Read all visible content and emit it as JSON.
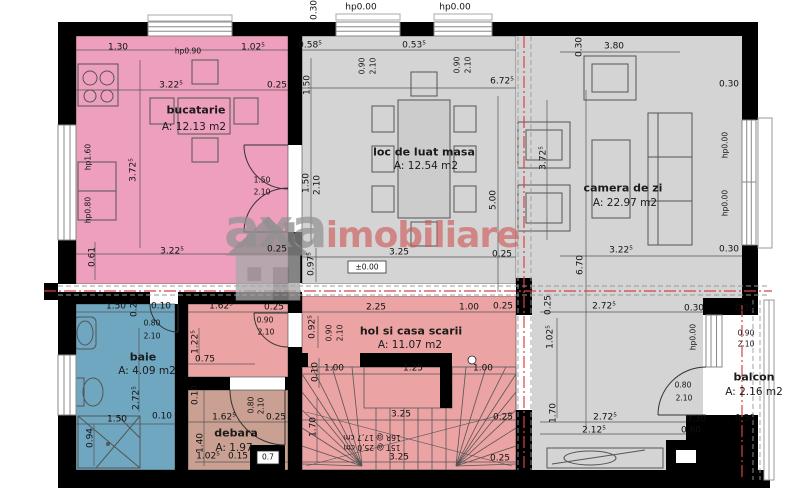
{
  "plan": {
    "type": "floor-plan",
    "language": "Romanian",
    "level_marker": "±0.00",
    "stair_notes": [
      "16R @ 17,7 cm",
      "15T @ 25,0 cm"
    ]
  },
  "watermark": {
    "part1": "axa",
    "part2": "imobiliare",
    "color1": "#919191",
    "color2": "#ce5555"
  },
  "colors": {
    "wall": "#000000",
    "section_line": "#d44444",
    "hidden_line": "#999999",
    "dining_gray": "#d4d4d4",
    "kitchen_pink": "#ed9fbd",
    "hall_salmon": "#eba3a3",
    "storage_tan": "#c9a091",
    "bath_blue": "#6fa7c1",
    "balcony_white": "#ffffff"
  },
  "rooms": [
    {
      "id": "bucatarie",
      "name": "bucatarie",
      "area": "A: 12.13 m2",
      "color": "#ed9fbd",
      "nx": 196,
      "ny": 110,
      "ax": 194,
      "ay": 127
    },
    {
      "id": "masa",
      "name": "loc de luat masa",
      "area": "A: 12.54 m2",
      "color": "#d4d4d4",
      "nx": 424,
      "ny": 152,
      "ax": 426,
      "ay": 166
    },
    {
      "id": "camera",
      "name": "camera de zi",
      "area": "A: 22.97 m2",
      "color": "#d4d4d4",
      "nx": 623,
      "ny": 188,
      "ax": 625,
      "ay": 203
    },
    {
      "id": "hol",
      "name": "hol si casa scarii",
      "area": "A: 11.07 m2",
      "color": "#eba3a3",
      "nx": 411,
      "ny": 331,
      "ax": 410,
      "ay": 345
    },
    {
      "id": "baie",
      "name": "baie",
      "area": "A: 4.09 m2",
      "color": "#6fa7c1",
      "nx": 143,
      "ny": 357,
      "ax": 147,
      "ay": 371
    },
    {
      "id": "debara",
      "name": "debara",
      "area": "A: 1.97",
      "color": "#c9a091",
      "nx": 236,
      "ny": 433,
      "ax": 234,
      "ay": 448
    },
    {
      "id": "balcon",
      "name": "balcon",
      "area": "A: 2.16 m2",
      "color": "#ffffff",
      "nx": 754,
      "ny": 377,
      "ax": 754,
      "ay": 392
    }
  ],
  "dims": [
    {
      "t": "0.30",
      "x": 315,
      "y": 10,
      "r": 1
    },
    {
      "t": "hp0.00",
      "x": 361,
      "y": 8
    },
    {
      "t": "hp0.00",
      "x": 455,
      "y": 8
    },
    {
      "t": "1.30",
      "x": 118,
      "y": 48
    },
    {
      "t": "hp0.90",
      "x": 188,
      "y": 51,
      "s": 1
    },
    {
      "t": "1.02⁵",
      "x": 253,
      "y": 48
    },
    {
      "t": "0.58⁵",
      "x": 310,
      "y": 46
    },
    {
      "t": "0.53⁵",
      "x": 414,
      "y": 46
    },
    {
      "t": "3.80",
      "x": 614,
      "y": 47
    },
    {
      "t": "0.30",
      "x": 580,
      "y": 47,
      "r": 1
    },
    {
      "t": "3.22⁵",
      "x": 171,
      "y": 86
    },
    {
      "t": "0.25",
      "x": 277,
      "y": 86
    },
    {
      "t": "6.72⁵",
      "x": 502,
      "y": 82
    },
    {
      "t": "0.90",
      "x": 362,
      "y": 66,
      "r": 1,
      "s": 1
    },
    {
      "t": "2.10",
      "x": 373,
      "y": 66,
      "r": 1,
      "s": 1
    },
    {
      "t": "0.90",
      "x": 457,
      "y": 65,
      "r": 1,
      "s": 1
    },
    {
      "t": "2.10",
      "x": 468,
      "y": 65,
      "r": 1,
      "s": 1
    },
    {
      "t": "1.50",
      "x": 308,
      "y": 85,
      "r": 1
    },
    {
      "t": "0.30",
      "x": 729,
      "y": 85
    },
    {
      "t": "3.72⁵",
      "x": 134,
      "y": 170,
      "r": 1
    },
    {
      "t": "hp1.60",
      "x": 88,
      "y": 157,
      "r": 1,
      "s": 1
    },
    {
      "t": "hp0.80",
      "x": 88,
      "y": 210,
      "r": 1,
      "s": 1
    },
    {
      "t": "1.50",
      "x": 262,
      "y": 180,
      "s": 1
    },
    {
      "t": "2.10",
      "x": 262,
      "y": 192,
      "s": 1
    },
    {
      "t": "hp0.00",
      "x": 725,
      "y": 145,
      "r": 1,
      "s": 1
    },
    {
      "t": "hp0.00",
      "x": 725,
      "y": 203,
      "r": 1,
      "s": 1
    },
    {
      "t": "3.72⁵",
      "x": 544,
      "y": 158,
      "r": 1
    },
    {
      "t": "1.50",
      "x": 307,
      "y": 183,
      "r": 1
    },
    {
      "t": "2.10",
      "x": 318,
      "y": 185,
      "r": 1
    },
    {
      "t": "5.00",
      "x": 494,
      "y": 200,
      "r": 1
    },
    {
      "t": "3.22⁵",
      "x": 172,
      "y": 252
    },
    {
      "t": "0.25",
      "x": 277,
      "y": 250
    },
    {
      "t": "0.61",
      "x": 93,
      "y": 257,
      "r": 1
    },
    {
      "t": "3.22⁵",
      "x": 621,
      "y": 251
    },
    {
      "t": "0.30",
      "x": 729,
      "y": 250
    },
    {
      "t": "6.70",
      "x": 581,
      "y": 265,
      "r": 1
    },
    {
      "t": "0.97⁵",
      "x": 312,
      "y": 264,
      "r": 1
    },
    {
      "t": "3.25",
      "x": 399,
      "y": 253
    },
    {
      "t": "±0.00",
      "x": 367,
      "y": 267,
      "s": 1
    },
    {
      "t": "0.25",
      "x": 502,
      "y": 255
    },
    {
      "t": "0.25",
      "x": 549,
      "y": 305,
      "r": 1
    },
    {
      "t": "2.72⁵",
      "x": 604,
      "y": 307
    },
    {
      "t": "0.30",
      "x": 694,
      "y": 309
    },
    {
      "t": "0.50",
      "x": 745,
      "y": 309
    },
    {
      "t": "1.02⁵",
      "x": 551,
      "y": 337,
      "r": 1
    },
    {
      "t": "hp0.00",
      "x": 693,
      "y": 337,
      "r": 1,
      "s": 1
    },
    {
      "t": "0.90",
      "x": 746,
      "y": 333,
      "s": 1
    },
    {
      "t": "2.10",
      "x": 746,
      "y": 344,
      "s": 1
    },
    {
      "t": "0.80",
      "x": 683,
      "y": 385,
      "s": 1
    },
    {
      "t": "2.10",
      "x": 684,
      "y": 398,
      "s": 1
    },
    {
      "t": "1.70",
      "x": 554,
      "y": 413,
      "r": 1
    },
    {
      "t": "2.72⁵",
      "x": 605,
      "y": 418
    },
    {
      "t": "0.30",
      "x": 696,
      "y": 420
    },
    {
      "t": "0.50",
      "x": 745,
      "y": 419
    },
    {
      "t": "2.12⁵",
      "x": 594,
      "y": 431
    },
    {
      "t": "0.60",
      "x": 691,
      "y": 431
    },
    {
      "t": "1.50",
      "x": 116,
      "y": 307
    },
    {
      "t": "0.25",
      "x": 135,
      "y": 307,
      "r": 1
    },
    {
      "t": "0.10",
      "x": 161,
      "y": 307
    },
    {
      "t": "1.62⁵",
      "x": 221,
      "y": 307
    },
    {
      "t": "0.25",
      "x": 274,
      "y": 308
    },
    {
      "t": "0.90",
      "x": 265,
      "y": 320,
      "s": 1
    },
    {
      "t": "2.10",
      "x": 266,
      "y": 332,
      "s": 1
    },
    {
      "t": "2.25",
      "x": 376,
      "y": 308
    },
    {
      "t": "1.00",
      "x": 469,
      "y": 308
    },
    {
      "t": "0.25",
      "x": 503,
      "y": 307
    },
    {
      "t": "0.80",
      "x": 152,
      "y": 323,
      "s": 1
    },
    {
      "t": "2.10",
      "x": 152,
      "y": 336,
      "s": 1
    },
    {
      "t": "0.92⁵",
      "x": 313,
      "y": 327,
      "r": 1
    },
    {
      "t": "0.90",
      "x": 329,
      "y": 333,
      "r": 1,
      "s": 1
    },
    {
      "t": "2.10",
      "x": 340,
      "y": 333,
      "r": 1,
      "s": 1
    },
    {
      "t": "1.22⁵",
      "x": 196,
      "y": 342,
      "r": 1
    },
    {
      "t": "0.75",
      "x": 205,
      "y": 360
    },
    {
      "t": "2.72⁵",
      "x": 137,
      "y": 398,
      "r": 1
    },
    {
      "t": "0.10",
      "x": 316,
      "y": 372,
      "r": 1
    },
    {
      "t": "1.00",
      "x": 334,
      "y": 369
    },
    {
      "t": "1.25",
      "x": 413,
      "y": 369
    },
    {
      "t": "1.00",
      "x": 483,
      "y": 369
    },
    {
      "t": "0.10",
      "x": 196,
      "y": 395,
      "r": 1
    },
    {
      "t": "0.80",
      "x": 251,
      "y": 405,
      "r": 1,
      "s": 1
    },
    {
      "t": "2.10",
      "x": 261,
      "y": 406,
      "r": 1,
      "s": 1
    },
    {
      "t": "1.62⁵",
      "x": 224,
      "y": 418
    },
    {
      "t": "0.25",
      "x": 276,
      "y": 418
    },
    {
      "t": "1.50",
      "x": 117,
      "y": 420
    },
    {
      "t": "0.10",
      "x": 162,
      "y": 417
    },
    {
      "t": "0.94",
      "x": 91,
      "y": 438,
      "r": 1
    },
    {
      "t": "1.40",
      "x": 201,
      "y": 443,
      "r": 1
    },
    {
      "t": "1.02⁵",
      "x": 208,
      "y": 457
    },
    {
      "t": "0.15",
      "x": 238,
      "y": 457
    },
    {
      "t": "0.7",
      "x": 268,
      "y": 457,
      "s": 1
    },
    {
      "t": "1.70",
      "x": 314,
      "y": 427,
      "r": 1
    },
    {
      "t": "3.25",
      "x": 401,
      "y": 415
    },
    {
      "t": "0.25",
      "x": 503,
      "y": 418
    },
    {
      "t": "3.25",
      "x": 399,
      "y": 458
    },
    {
      "t": "0.25",
      "x": 500,
      "y": 459
    },
    {
      "t": "16R @ 17,7 cm",
      "x": 372,
      "y": 437,
      "u": 1,
      "s": 1
    },
    {
      "t": "15T @ 25,0 cm",
      "x": 372,
      "y": 447,
      "u": 1,
      "s": 1
    }
  ]
}
